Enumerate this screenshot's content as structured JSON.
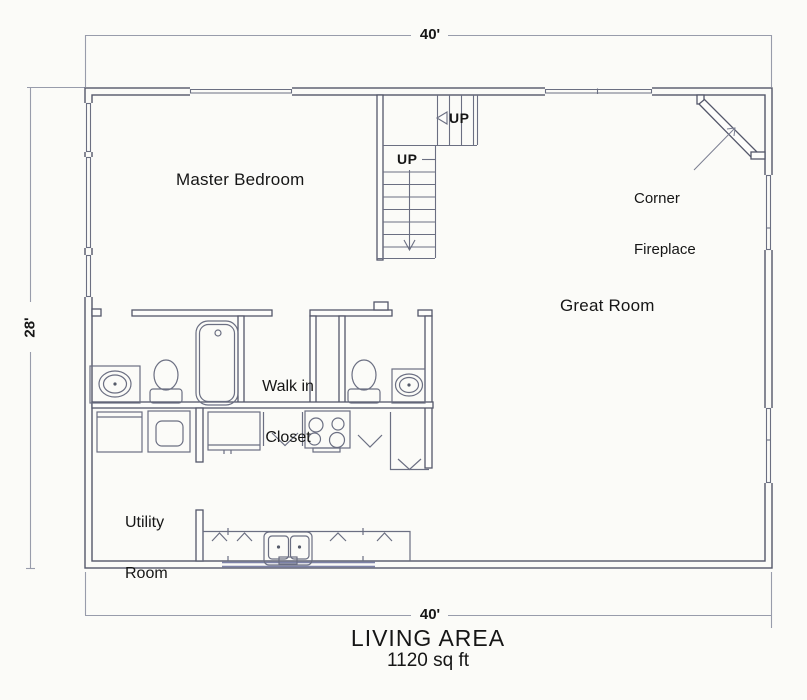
{
  "dimensions": {
    "top": "40'",
    "bottom": "40'",
    "left": "28'"
  },
  "rooms": {
    "master_bedroom": "Master Bedroom",
    "great_room": "Great Room",
    "walk_in_closet": {
      "line1": "Walk in",
      "line2": "Closet"
    },
    "utility_room": {
      "line1": "Utility",
      "line2": "Room"
    }
  },
  "annotations": {
    "corner_fireplace": {
      "line1": "Corner",
      "line2": "Fireplace"
    },
    "stairs_upper_label": "UP",
    "stairs_lower_label": "UP"
  },
  "footer": {
    "living_area_title": "LIVING AREA",
    "living_area_size": "1120 sq ft"
  },
  "colors": {
    "wall_line": "#54576a",
    "fixture_line": "#6b6f82",
    "dimension_line": "#989cab",
    "window_accent": "#7d82a8",
    "paper": "#fbfbf8"
  }
}
